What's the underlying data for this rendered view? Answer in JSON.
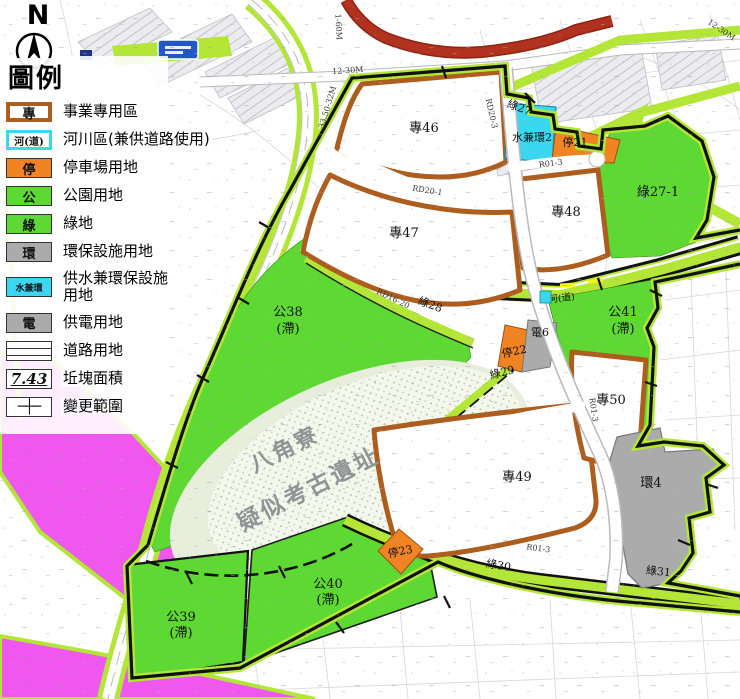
{
  "compass": {
    "north": "N"
  },
  "legend": {
    "title": "圖例",
    "items": [
      {
        "key": "專",
        "label": "事業專用區"
      },
      {
        "key": "河(道)",
        "label": "河川區(兼供道路使用)"
      },
      {
        "key": "停",
        "label": "停車場用地"
      },
      {
        "key": "公",
        "label": "公園用地"
      },
      {
        "key": "綠",
        "label": "綠地"
      },
      {
        "key": "環",
        "label": "環保設施用地"
      },
      {
        "key": "水兼環",
        "label": "供水兼環保設施用地"
      },
      {
        "key": "電",
        "label": "供電用地"
      },
      {
        "key": "",
        "label": "道路用地"
      },
      {
        "key": "7.43",
        "label": "坵塊面積"
      },
      {
        "key": "─┼─",
        "label": "變更範圍"
      }
    ]
  },
  "map": {
    "labels": {
      "z46": "專46",
      "z47": "專47",
      "z48": "專48",
      "z49": "專49",
      "z50": "專50",
      "p38": "公38",
      "p39": "公39",
      "p40": "公40",
      "p41": "公41",
      "drain": "(滯)",
      "g27": "綠27",
      "g27_1": "綠27-1",
      "g28": "綠28",
      "g29": "綠29",
      "g30": "綠30",
      "g31": "綠31",
      "water_env2": "水兼環2",
      "park21": "停21",
      "park22": "停22",
      "park23": "停23",
      "power6": "電6",
      "env4": "環4",
      "river_road": "河(道)"
    },
    "site_label": {
      "line1": "八角寮",
      "line2": "疑似考古遺址"
    },
    "road_labels": {
      "r1_60m": "1-60M",
      "r12_30m_a": "12-30M",
      "r12_30m_b": "12-30M",
      "r33_50_32m": "33.50-32M",
      "rd20_1": "RD20-1",
      "rd20_3": "RD20-3",
      "rd16_20": "RD16-20",
      "r01_3a": "R01-3",
      "r01_3b": "R01-3",
      "r01_3c": "R01-3"
    },
    "colors": {
      "zone_green": "#5ED832",
      "strip_green": "#B4E637",
      "special_brown": "#AD5E1E",
      "parking_orange": "#F08322",
      "water_cyan": "#3BD6EF",
      "power_gray": "#ABABAB",
      "magenta": "#F057EE",
      "red_road": "#B0321F",
      "boundary_black": "#111111",
      "arch_site_bg": "#EDF1E1"
    }
  }
}
